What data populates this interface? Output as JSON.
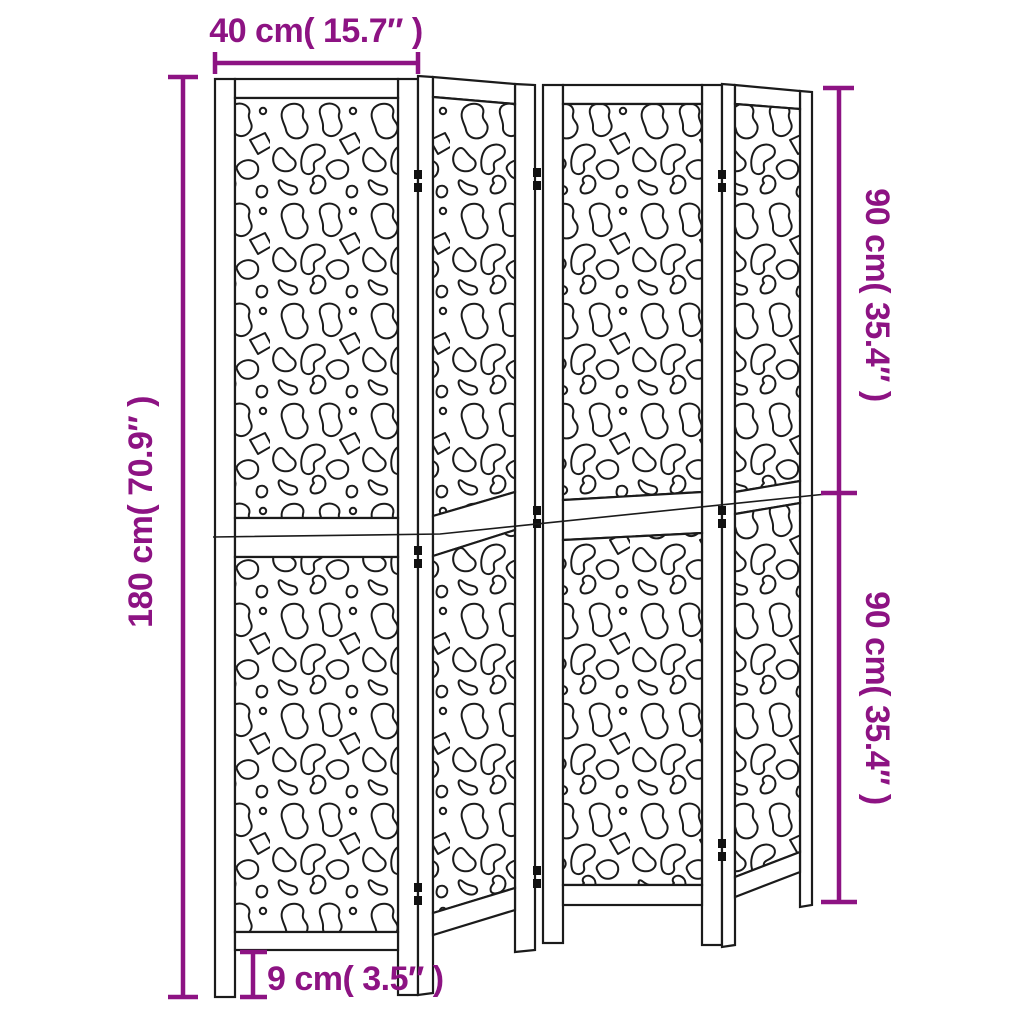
{
  "diagram": {
    "type": "product-dimension-diagram",
    "panel_count": 4,
    "dimensions": {
      "top_width": "40 cm( 15.7″ )",
      "left_height": "180 cm( 70.9″ )",
      "right_upper_height": "90 cm( 35.4″ )",
      "right_lower_height": "90 cm( 35.4″ )",
      "leg_height": "9 cm( 3.5″ )"
    },
    "colors": {
      "dimension_accent": "#8D1383",
      "drawing_line": "#1b1b1b",
      "background": "#ffffff"
    }
  }
}
